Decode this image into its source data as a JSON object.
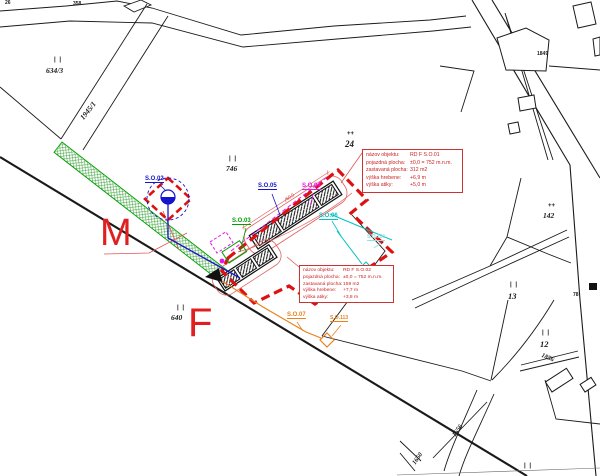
{
  "colors": {
    "boundary_red": "#dd1111",
    "utility_blue": "#1414cc",
    "utility_magenta": "#e816e8",
    "utility_green": "#00a000",
    "utility_cyan": "#00c2c2",
    "utility_orange": "#e8821e",
    "annotation_red": "#cc2222",
    "area_letter_red": "#e02020"
  },
  "parcel_labels": [
    {
      "symbol": "| |",
      "number": "634/3"
    },
    {
      "symbol": "| |",
      "number": "746"
    },
    {
      "symbol": "++",
      "number": "24"
    },
    {
      "symbol": "++",
      "number": "142"
    },
    {
      "symbol": "| |",
      "number": "13"
    },
    {
      "symbol": "| |",
      "number": "12"
    },
    {
      "symbol": "| |",
      "number": "640"
    },
    {
      "symbol": "| |",
      "number": ""
    }
  ],
  "road_labels": [
    {
      "text": "1945/1"
    },
    {
      "text": "1856"
    },
    {
      "text": "1650"
    },
    {
      "text": "1656"
    }
  ],
  "small_labels": [
    {
      "text": "26"
    },
    {
      "text": "358"
    },
    {
      "text": "1849"
    },
    {
      "text": "78"
    }
  ],
  "site_object_labels": [
    {
      "text": "S.O.02"
    },
    {
      "text": "S.O.05"
    },
    {
      "text": "S.O.04"
    },
    {
      "text": "S.O.03"
    },
    {
      "text": "S.O.06"
    },
    {
      "text": "S.O.121"
    },
    {
      "text": "S.O.07"
    },
    {
      "text": "S.O.113"
    }
  ],
  "area_letters": {
    "m": "M",
    "f": "F"
  },
  "dimension_label": "50,0",
  "annotation_boxes": [
    {
      "rows": [
        {
          "label": "názov objektu:",
          "value": "RD F S.O.01"
        },
        {
          "label": "pojazdná plocha:",
          "value": "±0,0 = 752 m.n.m."
        },
        {
          "label": "zastavaná plocha:",
          "value": "312 m2"
        },
        {
          "label": "výška hrebene:",
          "value": "+6,9 m"
        },
        {
          "label": "výška atiky:",
          "value": "+5,0 m"
        }
      ]
    },
    {
      "rows": [
        {
          "label": "názov objektu:",
          "value": "RD F S.O.02"
        },
        {
          "label": "pojazdná plocha:",
          "value": "±0,0 = 752 m.n.m."
        },
        {
          "label": "zastavaná plocha:",
          "value": "159 m2"
        },
        {
          "label": "výška hrebene:",
          "value": "+7,7 m"
        },
        {
          "label": "výška atiky:",
          "value": "+3,8 m"
        }
      ]
    }
  ]
}
